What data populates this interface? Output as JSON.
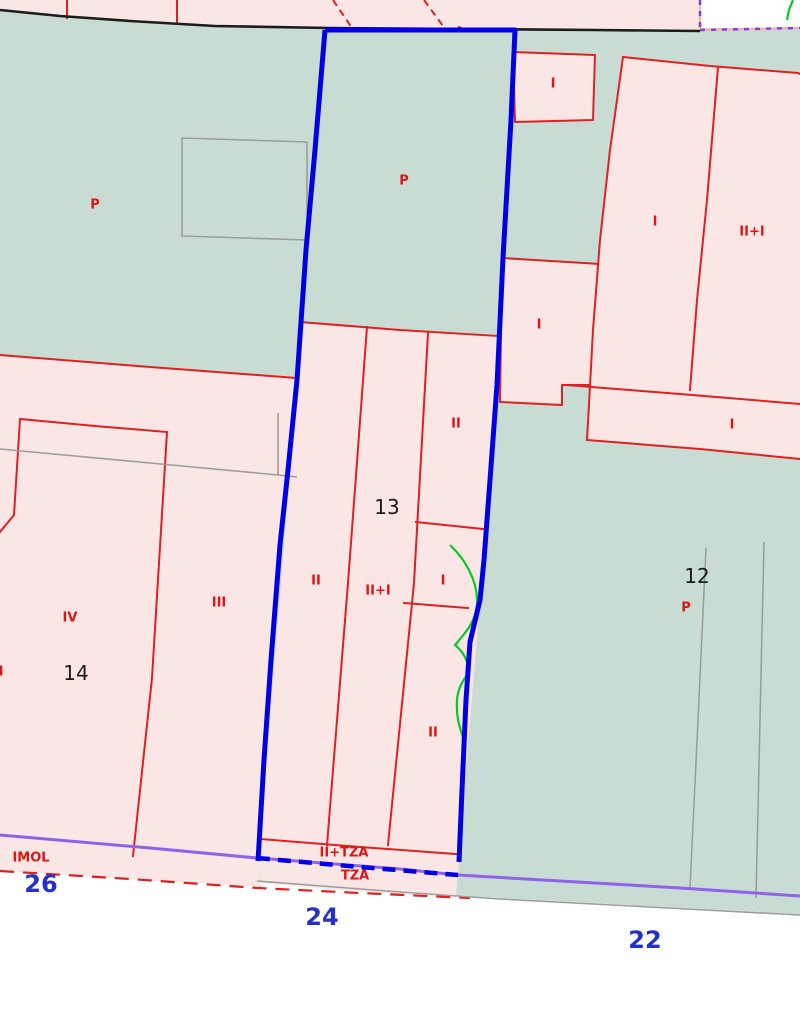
{
  "map": {
    "title": "Cadastral parcel map",
    "selected_parcel": "13",
    "block_numbers": [
      "14",
      "13",
      "12"
    ],
    "street_numbers": [
      "26",
      "24",
      "22"
    ],
    "colors": {
      "urban_block_fill": "#c9dcd3",
      "building_fill": "#fbe6e6",
      "building_line": "#dd2020",
      "selected_outline": "#0000e6",
      "street_line": "#1c1c1c",
      "subparcel_line": "#9c9c9c",
      "boundary_line": "#8f62ea",
      "overlay_green": "#00cc22",
      "parcel_text": "#1a1a1a",
      "street_text": "#2431c8",
      "height_text": "#dd1515",
      "street_fill": "#ffffff"
    },
    "labels": [
      {
        "text": "P",
        "x": 95,
        "y": 205,
        "kind": "height"
      },
      {
        "text": "P",
        "x": 404,
        "y": 181,
        "kind": "height"
      },
      {
        "text": "I",
        "x": 553,
        "y": 84,
        "kind": "height"
      },
      {
        "text": "I",
        "x": 655,
        "y": 222,
        "kind": "height"
      },
      {
        "text": "II+I",
        "x": 752,
        "y": 232,
        "kind": "height"
      },
      {
        "text": "I",
        "x": 539,
        "y": 325,
        "kind": "height"
      },
      {
        "text": "II",
        "x": 456,
        "y": 424,
        "kind": "height"
      },
      {
        "text": "I",
        "x": 732,
        "y": 425,
        "kind": "height"
      },
      {
        "text": "13",
        "x": 387,
        "y": 507,
        "kind": "parcel"
      },
      {
        "text": "12",
        "x": 697,
        "y": 576,
        "kind": "parcel"
      },
      {
        "text": "P",
        "x": 686,
        "y": 608,
        "kind": "height"
      },
      {
        "text": "II",
        "x": 316,
        "y": 581,
        "kind": "height"
      },
      {
        "text": "II+I",
        "x": 378,
        "y": 591,
        "kind": "height"
      },
      {
        "text": "I",
        "x": 443,
        "y": 581,
        "kind": "height"
      },
      {
        "text": "IV",
        "x": 70,
        "y": 618,
        "kind": "height"
      },
      {
        "text": "III",
        "x": 219,
        "y": 603,
        "kind": "height"
      },
      {
        "text": "I",
        "x": 1,
        "y": 672,
        "kind": "height"
      },
      {
        "text": "14",
        "x": 76,
        "y": 673,
        "kind": "parcel"
      },
      {
        "text": "II",
        "x": 433,
        "y": 733,
        "kind": "height"
      },
      {
        "text": "IMOL",
        "x": 31,
        "y": 858,
        "kind": "height"
      },
      {
        "text": "II+TZA",
        "x": 344,
        "y": 853,
        "kind": "height"
      },
      {
        "text": "TZA",
        "x": 355,
        "y": 876,
        "kind": "height"
      },
      {
        "text": "26",
        "x": 41,
        "y": 884,
        "kind": "street"
      },
      {
        "text": "24",
        "x": 322,
        "y": 917,
        "kind": "street"
      },
      {
        "text": "22",
        "x": 645,
        "y": 940,
        "kind": "street"
      }
    ]
  }
}
